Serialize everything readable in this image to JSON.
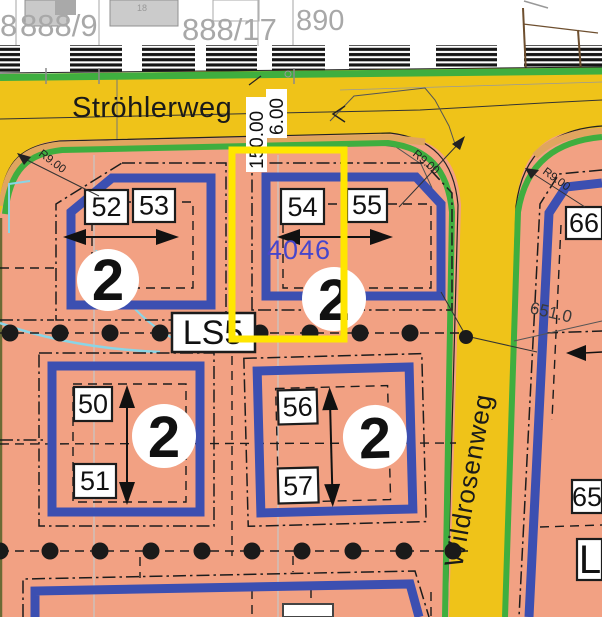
{
  "map": {
    "top_parcels": {
      "p8": "8",
      "p888_9": "888/9",
      "p888_17": "888/17",
      "p890": "890",
      "building_no": "18"
    },
    "streets": {
      "horizontal": "Ströhlerweg",
      "vertical": "Wildrosenweg"
    },
    "selection": {
      "parcel_number": "4046",
      "dim_length": "150.00",
      "dim_width": "6.00"
    },
    "labels": {
      "ls": "LS5",
      "l_partial": "L",
      "elevation": "651.0",
      "radius": "R9.00"
    },
    "blocks": {
      "nw": {
        "plots": [
          "52",
          "53"
        ],
        "storeys": "2"
      },
      "n": {
        "plots": [
          "54",
          "55"
        ],
        "storeys": "2"
      },
      "sw": {
        "plots": [
          "50",
          "51"
        ],
        "storeys": "2"
      },
      "s": {
        "plots": [
          "56",
          "57"
        ],
        "storeys": "2"
      },
      "e": {
        "plots": [
          "66",
          "65"
        ]
      }
    }
  },
  "colors": {
    "zone_salmon": "#F2A183",
    "street_yellow": "#EFC319",
    "curb_green": "#3FAE3F",
    "sidewalk_tan": "#E0A55F",
    "outline_blue": "#3C4FB1",
    "highlight_yellow": "#FFE600",
    "parcel_gray": "#A8A8A8",
    "parcel_number_blue": "#4646CC",
    "contour_cyan": "#8AD5E6"
  }
}
